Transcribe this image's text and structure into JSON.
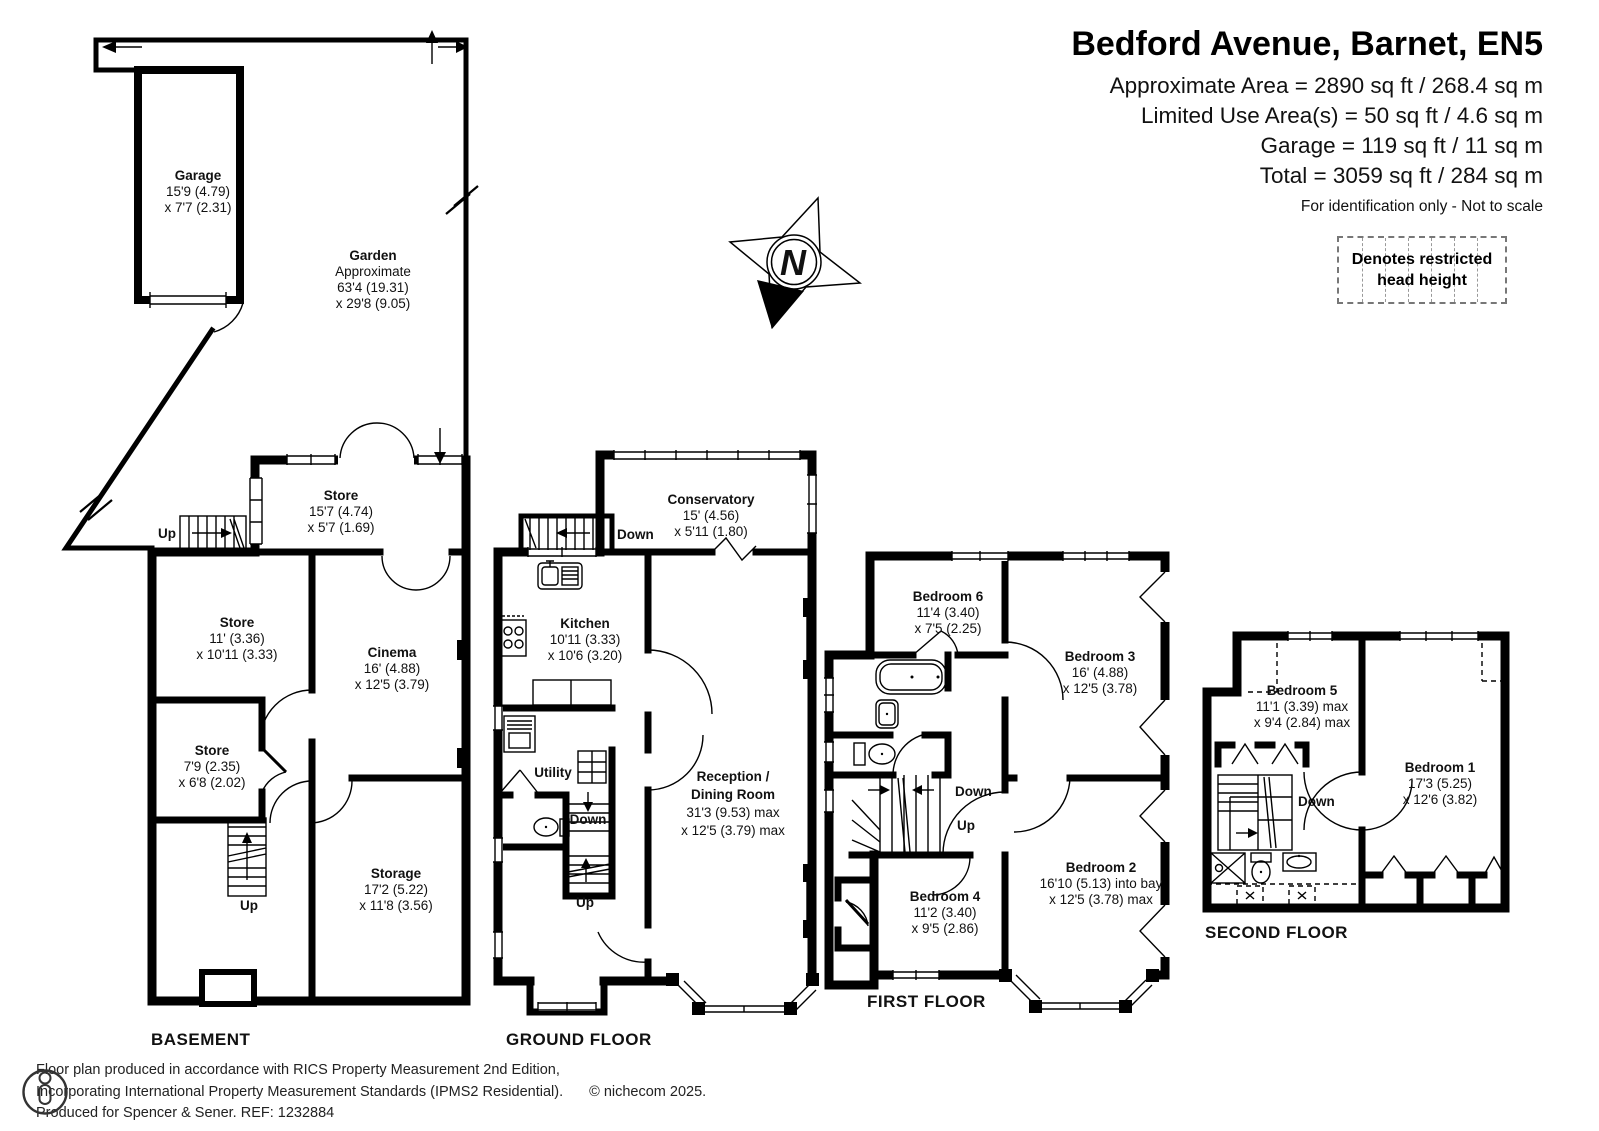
{
  "title_block": {
    "title": "Bedford Avenue, Barnet, EN5",
    "area_lines": [
      "Approximate Area = 2890 sq ft / 268.4 sq m",
      "Limited Use Area(s) = 50 sq ft / 4.6 sq m",
      "Garage = 119 sq ft / 11 sq m",
      "Total = 3059 sq ft / 284 sq m"
    ],
    "note": "For identification only - Not to scale"
  },
  "legend": {
    "line1": "Denotes restricted",
    "line2": "head height"
  },
  "compass": {
    "north_label": "N"
  },
  "outdoor": {
    "garage": {
      "name": "Garage",
      "dims": [
        "15'9 (4.79)",
        "x 7'7 (2.31)"
      ]
    },
    "garden": {
      "name": "Garden",
      "note": "Approximate",
      "dims": [
        "63'4 (19.31)",
        "x 29'8 (9.05)"
      ]
    }
  },
  "basement": {
    "floor_label": "BASEMENT",
    "store_top": {
      "name": "Store",
      "dims": [
        "15'7 (4.74)",
        "x 5'7 (1.69)"
      ]
    },
    "store_mid": {
      "name": "Store",
      "dims": [
        "11' (3.36)",
        "x 10'11 (3.33)"
      ]
    },
    "cinema": {
      "name": "Cinema",
      "dims": [
        "16' (4.88)",
        "x 12'5 (3.79)"
      ]
    },
    "store_small": {
      "name": "Store",
      "dims": [
        "7'9 (2.35)",
        "x 6'8 (2.02)"
      ]
    },
    "storage": {
      "name": "Storage",
      "dims": [
        "17'2 (5.22)",
        "x 11'8 (3.56)"
      ]
    },
    "stair_up_top": "Up",
    "stair_up_bottom": "Up"
  },
  "ground_floor": {
    "floor_label": "GROUND FLOOR",
    "conservatory": {
      "name": "Conservatory",
      "dims": [
        "15' (4.56)",
        "x 5'11 (1.80)"
      ]
    },
    "kitchen": {
      "name": "Kitchen",
      "dims": [
        "10'11 (3.33)",
        "x 10'6 (3.20)"
      ]
    },
    "utility": {
      "name": "Utility"
    },
    "reception": {
      "name": "Reception /",
      "name2": "Dining Room",
      "dims": [
        "31'3 (9.53) max",
        "x 12'5 (3.79) max"
      ]
    },
    "stair_down_top": "Down",
    "stair_down_mid": "Down",
    "stair_up_mid": "Up"
  },
  "first_floor": {
    "floor_label": "FIRST FLOOR",
    "bedroom6": {
      "name": "Bedroom 6",
      "dims": [
        "11'4 (3.40)",
        "x 7'5 (2.25)"
      ]
    },
    "bedroom3": {
      "name": "Bedroom 3",
      "dims": [
        "16' (4.88)",
        "x 12'5 (3.78)"
      ]
    },
    "bedroom4": {
      "name": "Bedroom 4",
      "dims": [
        "11'2 (3.40)",
        "x 9'5 (2.86)"
      ]
    },
    "bedroom2": {
      "name": "Bedroom 2",
      "dims": [
        "16'10 (5.13) into bay",
        "x 12'5 (3.78) max"
      ]
    },
    "stair_down": "Down",
    "stair_up": "Up"
  },
  "second_floor": {
    "floor_label": "SECOND FLOOR",
    "bedroom5": {
      "name": "Bedroom 5",
      "dims": [
        "11'1 (3.39) max",
        "x 9'4 (2.84) max"
      ]
    },
    "bedroom1": {
      "name": "Bedroom 1",
      "dims": [
        "17'3 (5.25)",
        "x 12'6 (3.82)"
      ]
    },
    "stair_down": "Down"
  },
  "footer": {
    "line1": "Floor plan produced in accordance with RICS Property Measurement 2nd Edition,",
    "line2": "Incorporating International Property Measurement Standards (IPMS2 Residential).",
    "copyright": "© nichecom 2025.",
    "line3": "Produced for Spencer & Sener.   REF: 1232884"
  },
  "colors": {
    "wall": "#000000",
    "background": "#ffffff",
    "text": "#111111"
  }
}
